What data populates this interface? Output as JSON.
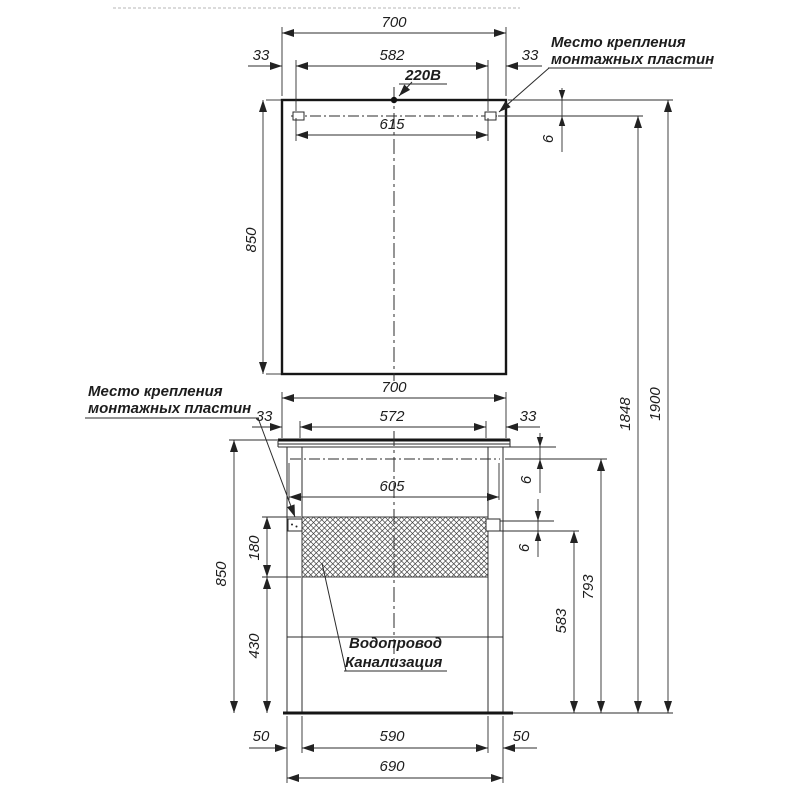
{
  "labels": {
    "power": "220В",
    "mount_top_1": "Место крепления",
    "mount_top_2": "монтажных пластин",
    "mount_left_1": "Место крепления",
    "mount_left_2": "монтажных пластин",
    "plumbing_1": "Водопровод",
    "plumbing_2": "Канализация"
  },
  "dims": {
    "mirror_width": "700",
    "mirror_offset_left": "33",
    "mirror_plate_inner": "582",
    "mirror_offset_right": "33",
    "mirror_plate_outer": "615",
    "mirror_height": "850",
    "mirror_plate_gap": "6",
    "vanity_width": "700",
    "vanity_offset_left": "33",
    "vanity_plate_inner": "572",
    "vanity_offset_right": "33",
    "vanity_plate_outer": "605",
    "vanity_top_gap": "6",
    "vanity_plate_gap": "6",
    "service_zone_height": "180",
    "vanity_height": "850",
    "service_zone_to_floor": "430",
    "plate_height_from_floor": "583",
    "mount_line_height_from_floor": "793",
    "mirror_plate_height_from_floor": "1848",
    "mirror_top_height_from_floor": "1900",
    "leg_left": "50",
    "leg_span": "590",
    "leg_right": "50",
    "base_width": "690"
  },
  "colors": {
    "line": "#2b2b2b",
    "background": "#ffffff"
  }
}
